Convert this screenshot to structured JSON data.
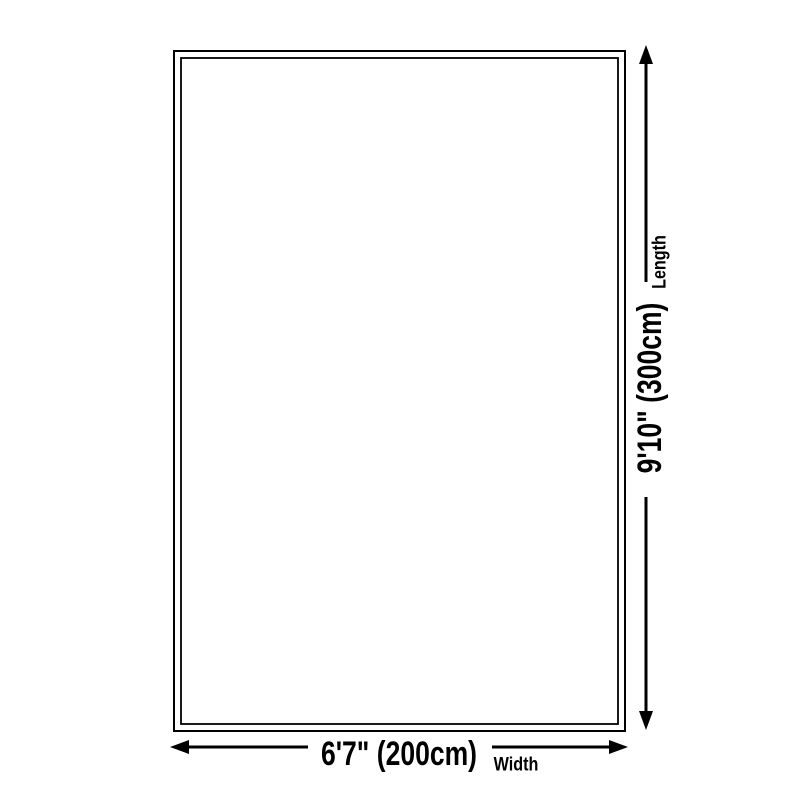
{
  "canvas": {
    "background_color": "#ffffff",
    "line_color": "#000000",
    "text_color": "#000000"
  },
  "product_outline": {
    "shape": "rectangle-double-border",
    "description": "rug-size-outline"
  },
  "dimensions": {
    "width": {
      "value": "6'7\" (200cm)",
      "label": "Width"
    },
    "length": {
      "value": "9'10\" (300cm)",
      "label": "Length"
    }
  }
}
